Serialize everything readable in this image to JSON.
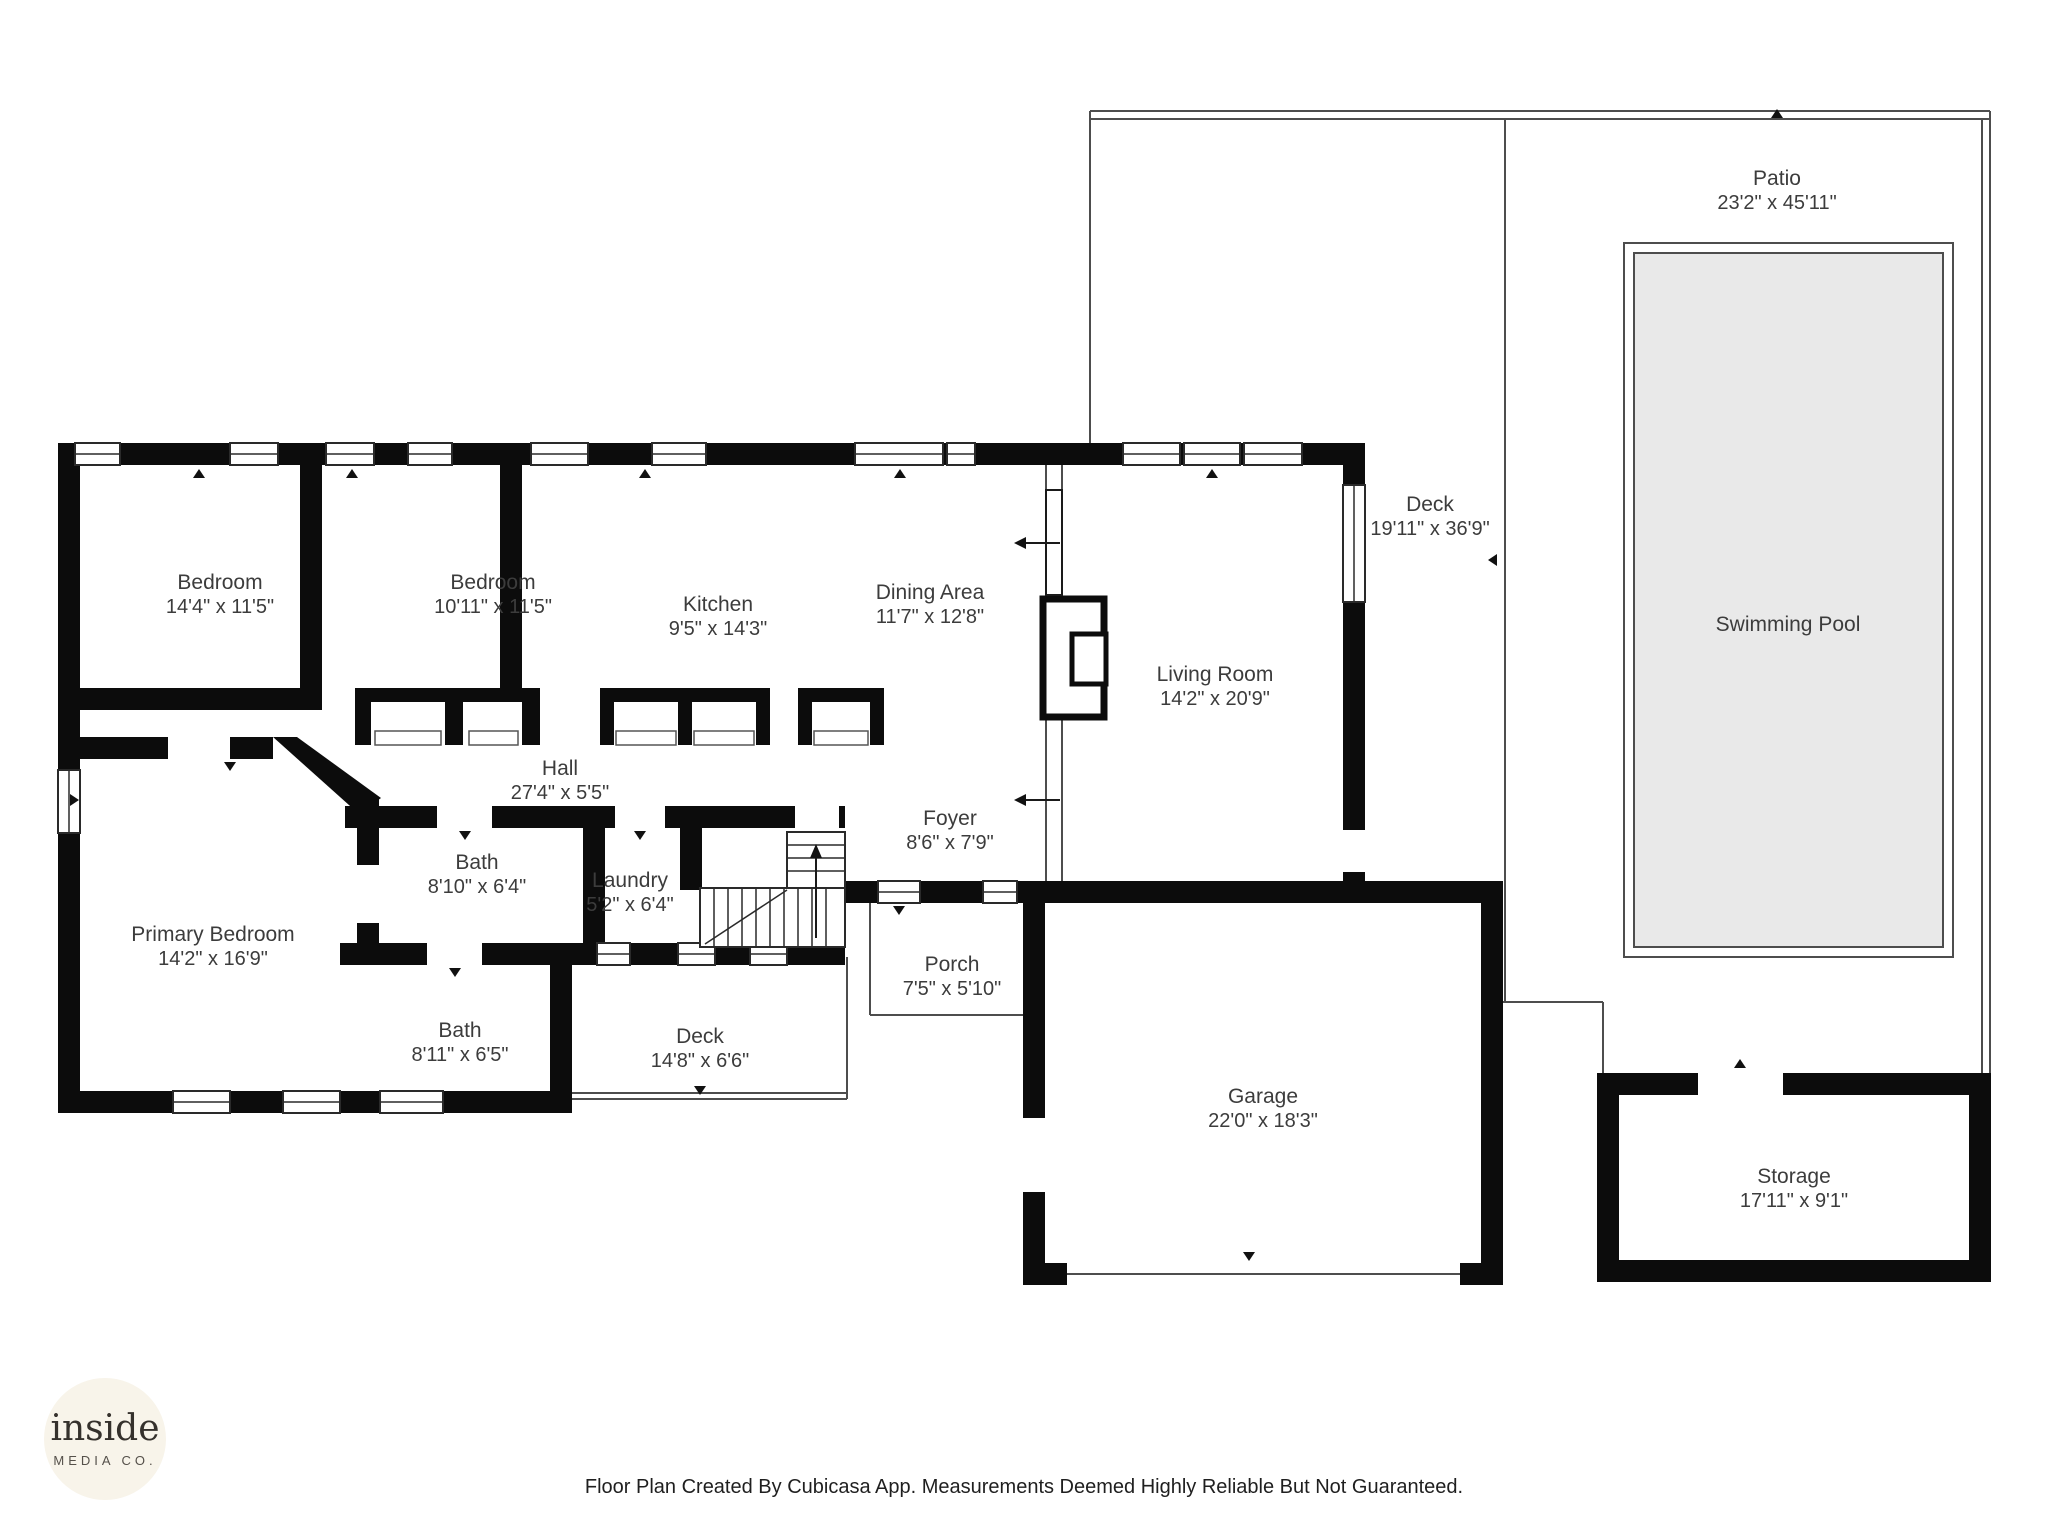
{
  "rooms": [
    {
      "id": "bedroom-1",
      "name": "Bedroom",
      "dims": "14'4\" x 11'5\""
    },
    {
      "id": "bedroom-2",
      "name": "Bedroom",
      "dims": "10'11\" x 11'5\""
    },
    {
      "id": "kitchen",
      "name": "Kitchen",
      "dims": "9'5\" x 14'3\""
    },
    {
      "id": "dining-area",
      "name": "Dining Area",
      "dims": "11'7\" x 12'8\""
    },
    {
      "id": "living-room",
      "name": "Living Room",
      "dims": "14'2\" x 20'9\""
    },
    {
      "id": "deck-right",
      "name": "Deck",
      "dims": "19'11\" x 36'9\""
    },
    {
      "id": "patio",
      "name": "Patio",
      "dims": "23'2\" x 45'11\""
    },
    {
      "id": "swimming-pool",
      "name": "Swimming Pool",
      "dims": ""
    },
    {
      "id": "hall",
      "name": "Hall",
      "dims": "27'4\" x 5'5\""
    },
    {
      "id": "foyer",
      "name": "Foyer",
      "dims": "8'6\" x 7'9\""
    },
    {
      "id": "primary-bedroom",
      "name": "Primary Bedroom",
      "dims": "14'2\" x 16'9\""
    },
    {
      "id": "bath-1",
      "name": "Bath",
      "dims": "8'10\" x 6'4\""
    },
    {
      "id": "laundry",
      "name": "Laundry",
      "dims": "5'2\" x 6'4\""
    },
    {
      "id": "bath-2",
      "name": "Bath",
      "dims": "8'11\" x 6'5\""
    },
    {
      "id": "deck-bottom",
      "name": "Deck",
      "dims": "14'8\" x 6'6\""
    },
    {
      "id": "porch",
      "name": "Porch",
      "dims": "7'5\" x 5'10\""
    },
    {
      "id": "garage",
      "name": "Garage",
      "dims": "22'0\" x 18'3\""
    },
    {
      "id": "storage",
      "name": "Storage",
      "dims": "17'11\" x 9'1\""
    }
  ],
  "logo": {
    "line1": "inside",
    "line2": "MEDIA CO."
  },
  "footer": {
    "text": "Floor Plan Created By Cubicasa App. Measurements Deemed Highly Reliable But Not Guaranteed."
  },
  "colors": {
    "wall": "#0c0c0c",
    "thin": "#4d4d4d",
    "pool": "#e9e9e9",
    "text": "#3c3c3c",
    "logo-bg": "#f8f4ea",
    "logo-text": "#35312c",
    "footer": "#1f1f1f"
  }
}
